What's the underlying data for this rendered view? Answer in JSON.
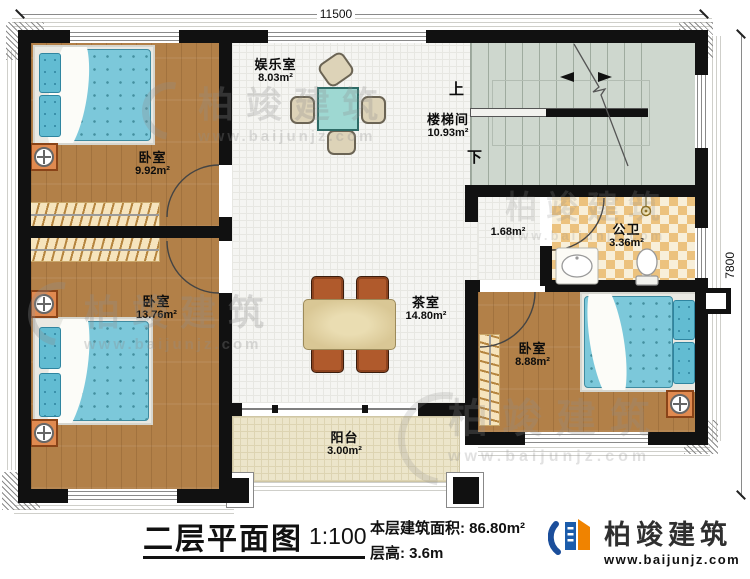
{
  "dimensions": {
    "top": "11500",
    "right": "7800"
  },
  "rooms": {
    "bedroom1": {
      "name": "卧室",
      "area": "9.92m²"
    },
    "bedroom2": {
      "name": "卧室",
      "area": "13.76m²"
    },
    "bedroom3": {
      "name": "卧室",
      "area": "8.88m²"
    },
    "entertainment": {
      "name": "娱乐室",
      "area": "8.03m²"
    },
    "stairwell": {
      "name": "楼梯间",
      "area": "10.93m²"
    },
    "hallway": {
      "area": "1.68m²"
    },
    "bathroom": {
      "name": "公卫",
      "area": "3.36m²"
    },
    "tearoom": {
      "name": "茶室",
      "area": "14.80m²"
    },
    "balcony": {
      "name": "阳台",
      "area": "3.00m²"
    }
  },
  "stairs": {
    "up": "上",
    "down": "下"
  },
  "title_block": {
    "title": "二层平面图",
    "scale": "1:100",
    "area_label": "本层建筑面积:",
    "area_value": "86.80m²",
    "height_label": "层高:",
    "height_value": "3.6m"
  },
  "brand": {
    "name": "柏竣建筑",
    "website": "www.baijunjz.com"
  },
  "watermark": {
    "name": "柏竣建筑",
    "website": "www.baijunjz.com"
  },
  "colors": {
    "wall": "#111111",
    "wood_floor": "#b28048",
    "hall_floor": "#f5f5f2",
    "stair_floor": "#ced7ce",
    "bath_tile": "#ecc27e",
    "balcony_floor": "#ece5ca",
    "bed": "#7cc8da",
    "nightstand": "#e08a50",
    "mahjong_table": "#9ed8d2",
    "dining_chair": "#b05a2c",
    "logo_blue": "#1b5cab",
    "logo_orange": "#f08300"
  }
}
